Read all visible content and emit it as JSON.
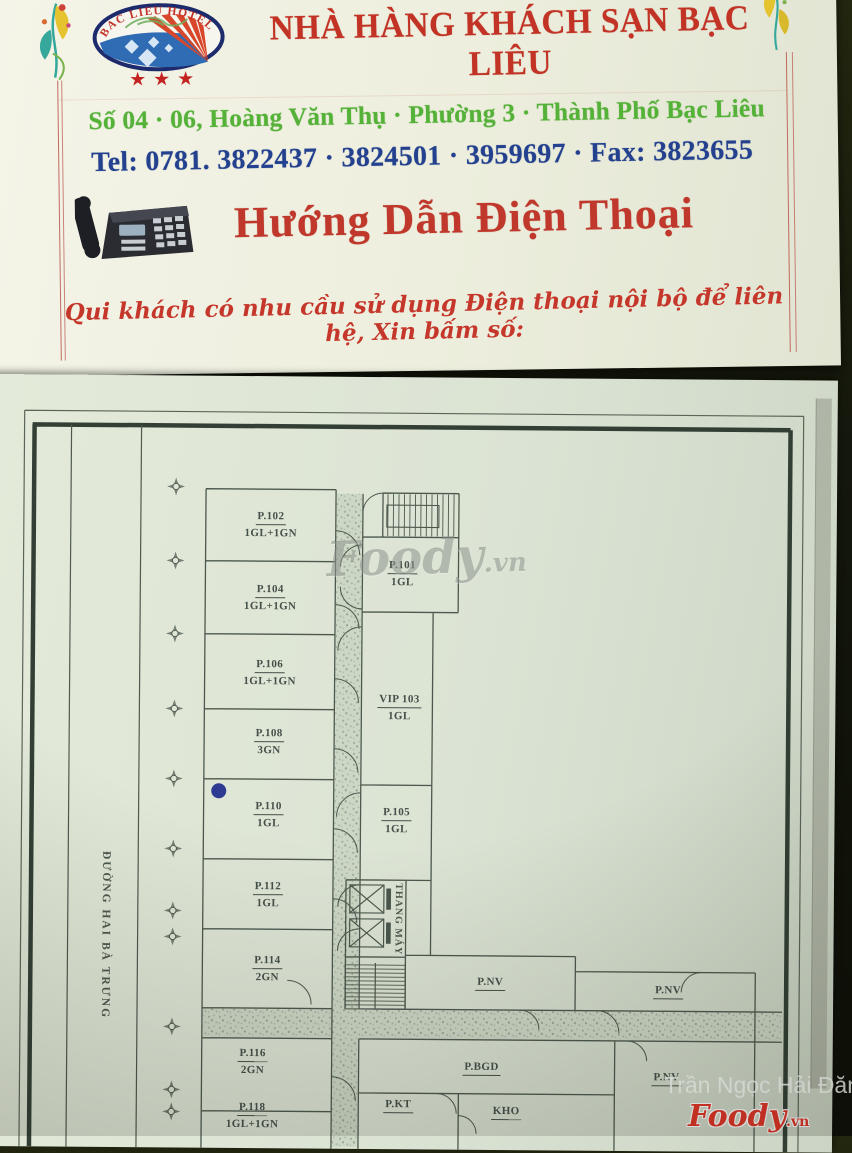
{
  "letterhead": {
    "logo": {
      "arc_text": "BAC LIEU HOTEL",
      "stars": "★★★"
    },
    "title": "NHÀ HÀNG KHÁCH SẠN BẠC LIÊU",
    "address": "Số 04 · 06, Hoàng Văn Thụ · Phường 3 · Thành Phố Bạc Liêu",
    "phone_line": "Tel: 0781. 3822437 · 3824501 · 3959697 · Fax: 3823655",
    "heading": "Hướng Dẫn Điện Thoại",
    "note": "Qui khách có nhu cầu sử dụng Điện thoại nội bộ để liên hệ, Xin bấm số:",
    "colors": {
      "title_red": "#c23325",
      "address_green": "#55b238",
      "phone_blue": "#23418f",
      "note_red": "#c5372b"
    }
  },
  "floor_plan": {
    "street_label": "ĐƯỜNG HAI BÀ TRƯNG",
    "elevator_label": "THANG MÁY",
    "rooms": [
      {
        "name": "P.102",
        "type": "1GL+1GN"
      },
      {
        "name": "P.104",
        "type": "1GL+1GN"
      },
      {
        "name": "P.106",
        "type": "1GL+1GN"
      },
      {
        "name": "P.108",
        "type": "3GN"
      },
      {
        "name": "P.110",
        "type": "1GL"
      },
      {
        "name": "P.112",
        "type": "1GL"
      },
      {
        "name": "P.114",
        "type": "2GN"
      },
      {
        "name": "P.116",
        "type": "2GN"
      },
      {
        "name": "P.118",
        "type": "1GL+1GN"
      },
      {
        "name": "P.101",
        "type": "1GL"
      },
      {
        "name": "VIP 103",
        "type": "1GL"
      },
      {
        "name": "P.105",
        "type": "1GL"
      },
      {
        "name": "P.NV",
        "type": ""
      },
      {
        "name": "P.NV",
        "type": ""
      },
      {
        "name": "P.NV",
        "type": ""
      },
      {
        "name": "P.BGD",
        "type": ""
      },
      {
        "name": "P.KT",
        "type": ""
      },
      {
        "name": "KHO",
        "type": ""
      }
    ]
  },
  "watermarks": {
    "center_brand": "Foody",
    "center_domain": ".vn",
    "author": "Trần Ngọc Hải Đăng",
    "brand": "Foody",
    "brand_domain": ".vn"
  }
}
